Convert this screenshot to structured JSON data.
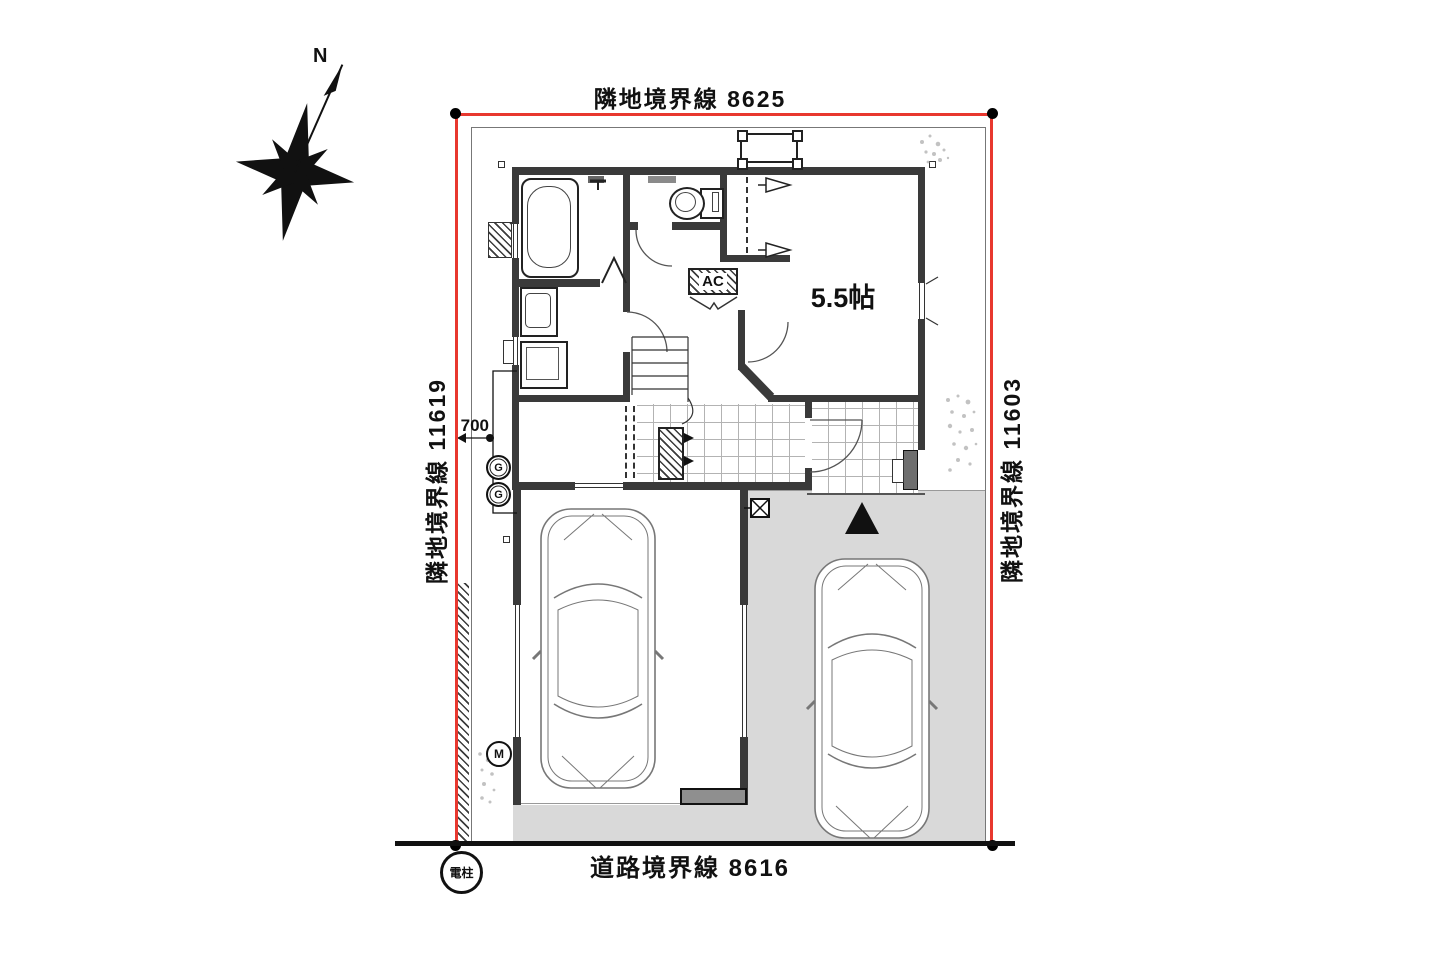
{
  "site_plan": {
    "boundaries": {
      "top_label": "隣地境界線 8625",
      "left_label": "隣地境界線 11619",
      "right_label": "隣地境界線 11603",
      "bottom_label": "道路境界線 8616",
      "boundary_line_color": "#e8382f"
    },
    "annotations": {
      "utility_pole_label": "電柱",
      "setback_dimension": "700",
      "gas_meter_label": "G",
      "gas_meter_2_label": "G",
      "electric_meter_label": "M"
    },
    "compass": {
      "north_label": "N"
    },
    "rooms": {
      "western_room_label": "5.5帖",
      "ac_label": "AC"
    },
    "icons": {
      "entrance_marker": "▲",
      "catch_basin": "box-with-x",
      "clothes_hanger": "triangle-hook"
    }
  }
}
